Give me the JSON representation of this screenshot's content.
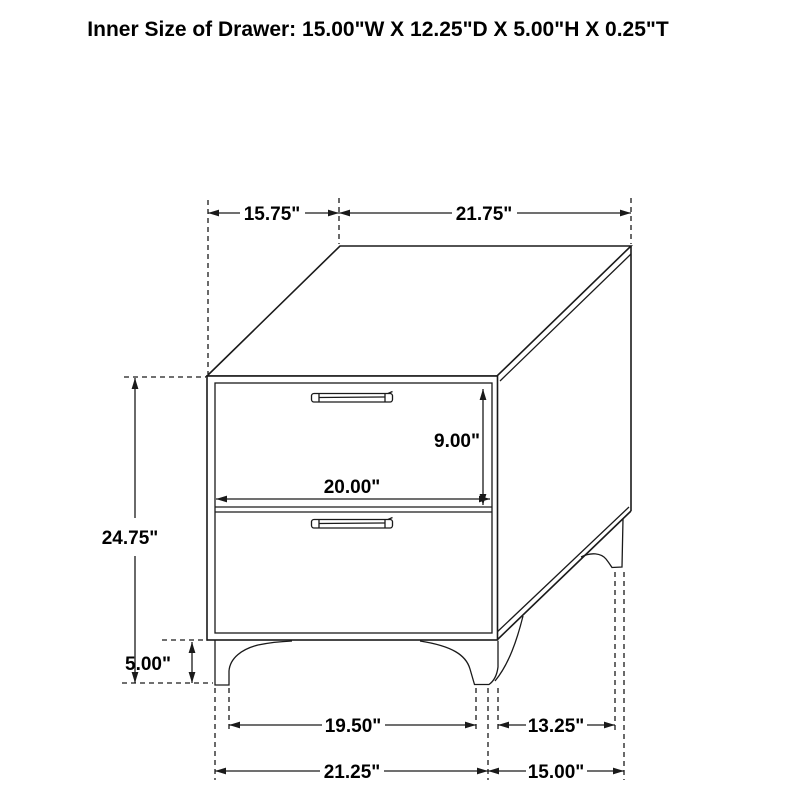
{
  "title": "Inner Size of Drawer: 15.00\"W X 12.25\"D X 5.00\"H X 0.25\"T",
  "diagram": {
    "type": "furniture dimension line drawing",
    "subject": "two-drawer nightstand, perspective view",
    "colors": {
      "line": "#1a1a1a",
      "background": "#ffffff",
      "text": "#000000"
    },
    "labels": {
      "top_depth": "15.75\"",
      "top_width": "21.75\"",
      "drawer_front_height": "9.00\"",
      "drawer_front_width": "20.00\"",
      "overall_height": "24.75\"",
      "leg_height": "5.00\"",
      "front_feet_inner_span": "19.50\"",
      "side_feet_inner_span": "13.25\"",
      "front_feet_outer_span": "21.25\"",
      "side_feet_outer_span": "15.00\""
    }
  }
}
